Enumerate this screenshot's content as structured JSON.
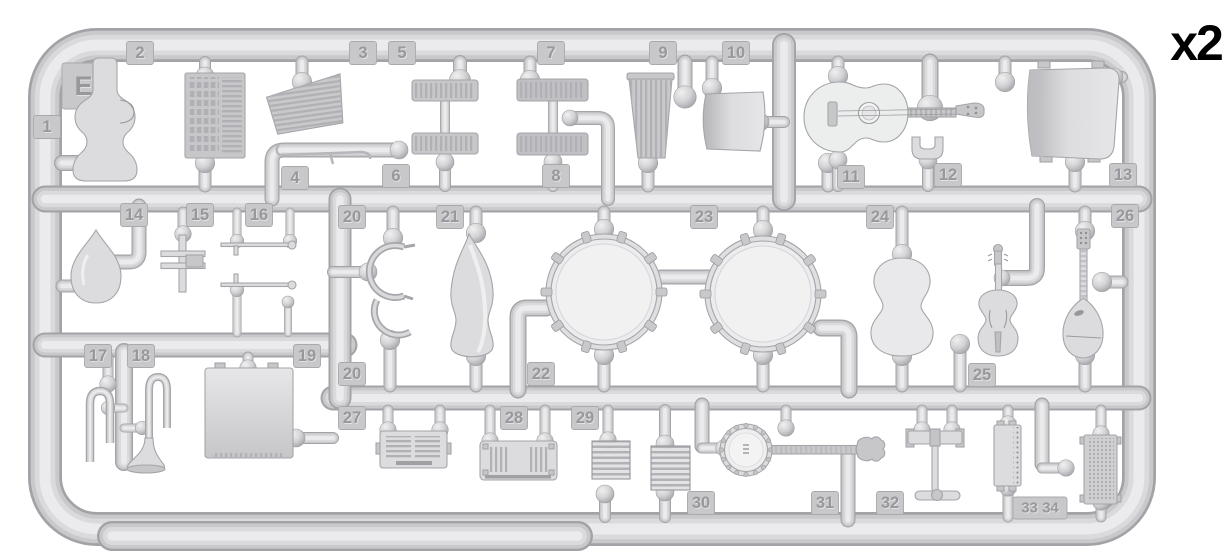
{
  "meta": {
    "sprue_code": "Ef",
    "quantity_label": "x2"
  },
  "colors": {
    "background": "#ffffff",
    "plastic": "#d5d5d7",
    "plastic_highlight": "#ececed",
    "plastic_shadow": "#a2a3a7",
    "tag_plate": "#c8c8cb",
    "tag_text": "#97989c",
    "quantity_text": "#000000"
  },
  "tags": [
    {
      "id": "tag-1",
      "label": "1"
    },
    {
      "id": "tag-2",
      "label": "2"
    },
    {
      "id": "tag-3",
      "label": "3"
    },
    {
      "id": "tag-5",
      "label": "5"
    },
    {
      "id": "tag-7",
      "label": "7"
    },
    {
      "id": "tag-9",
      "label": "9"
    },
    {
      "id": "tag-10",
      "label": "10"
    },
    {
      "id": "tag-4",
      "label": "4"
    },
    {
      "id": "tag-6",
      "label": "6"
    },
    {
      "id": "tag-8",
      "label": "8"
    },
    {
      "id": "tag-11",
      "label": "11"
    },
    {
      "id": "tag-12",
      "label": "12"
    },
    {
      "id": "tag-13",
      "label": "13"
    },
    {
      "id": "tag-14",
      "label": "14"
    },
    {
      "id": "tag-15",
      "label": "15"
    },
    {
      "id": "tag-16",
      "label": "16"
    },
    {
      "id": "tag-20-top",
      "label": "20"
    },
    {
      "id": "tag-21",
      "label": "21"
    },
    {
      "id": "tag-23",
      "label": "23"
    },
    {
      "id": "tag-24",
      "label": "24"
    },
    {
      "id": "tag-26",
      "label": "26"
    },
    {
      "id": "tag-17",
      "label": "17"
    },
    {
      "id": "tag-18",
      "label": "18"
    },
    {
      "id": "tag-19",
      "label": "19"
    },
    {
      "id": "tag-20-bottom",
      "label": "20"
    },
    {
      "id": "tag-22",
      "label": "22"
    },
    {
      "id": "tag-25",
      "label": "25"
    },
    {
      "id": "tag-27",
      "label": "27"
    },
    {
      "id": "tag-28",
      "label": "28"
    },
    {
      "id": "tag-29",
      "label": "29"
    },
    {
      "id": "tag-30",
      "label": "30"
    },
    {
      "id": "tag-31",
      "label": "31"
    },
    {
      "id": "tag-32",
      "label": "32"
    },
    {
      "id": "tag-33-34",
      "label": "33 34"
    }
  ],
  "parts": [
    {
      "number": 1,
      "name": "instrument case"
    },
    {
      "number": 2,
      "name": "accordion keyboard panel"
    },
    {
      "number": 3,
      "name": "folding fan bellows"
    },
    {
      "number": 4,
      "name": "thin rod"
    },
    {
      "number": 5,
      "name": "slatted bar"
    },
    {
      "number": 6,
      "name": "slatted bar"
    },
    {
      "number": 7,
      "name": "slatted bar"
    },
    {
      "number": 8,
      "name": "slatted bar"
    },
    {
      "number": 9,
      "name": "pleated bellows"
    },
    {
      "number": 10,
      "name": "curved panel"
    },
    {
      "number": 11,
      "name": "acoustic guitar"
    },
    {
      "number": 12,
      "name": "small bracket"
    },
    {
      "number": 13,
      "name": "curved shell panel"
    },
    {
      "number": 14,
      "name": "teardrop instrument body"
    },
    {
      "number": 15,
      "name": "valve cross piece"
    },
    {
      "number": 16,
      "name": "thin rods"
    },
    {
      "number": 17,
      "name": "u-shaped tube"
    },
    {
      "number": 18,
      "name": "bugle horn"
    },
    {
      "number": 19,
      "name": "large box panel"
    },
    {
      "number": 20,
      "name": "c-shaped hooks"
    },
    {
      "number": 21,
      "name": "instrument case lid"
    },
    {
      "number": 22,
      "name": "drum"
    },
    {
      "number": 23,
      "name": "drum"
    },
    {
      "number": 24,
      "name": "guitar body back"
    },
    {
      "number": 25,
      "name": "violin"
    },
    {
      "number": 26,
      "name": "mandolin"
    },
    {
      "number": 27,
      "name": "louvered box"
    },
    {
      "number": 28,
      "name": "vented box"
    },
    {
      "number": 29,
      "name": "bellows stack"
    },
    {
      "number": 30,
      "name": "bellows stack"
    },
    {
      "number": 31,
      "name": "banjo"
    },
    {
      "number": 32,
      "name": "stand base"
    },
    {
      "number": 33,
      "name": "riveted plate"
    },
    {
      "number": 34,
      "name": "mesh grille"
    }
  ]
}
